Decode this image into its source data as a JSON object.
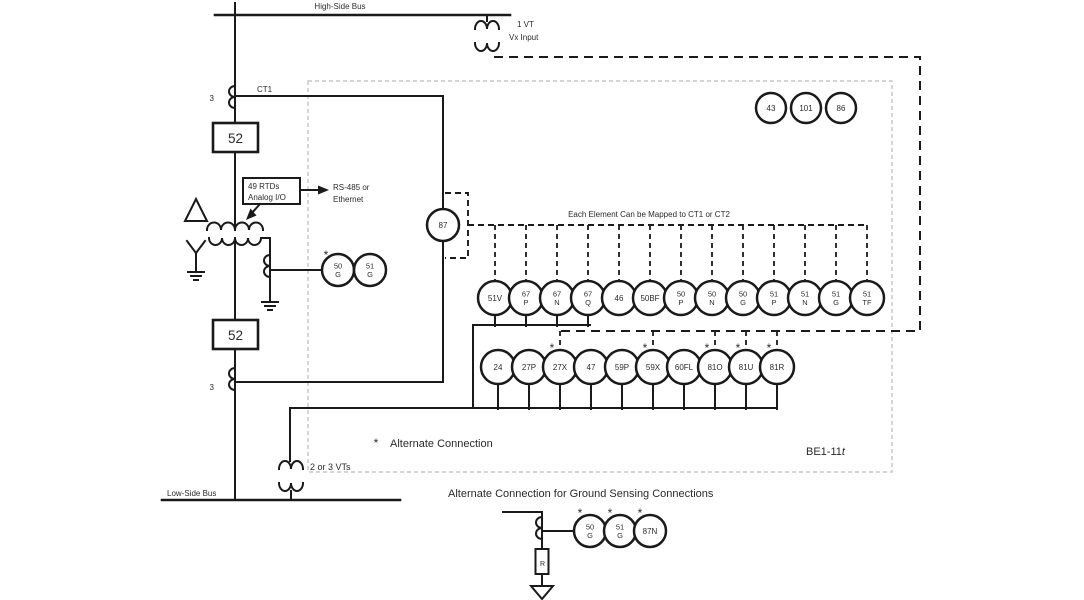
{
  "labels": {
    "high_side_bus": "High-Side Bus",
    "low_side_bus": "Low-Side Bus",
    "vt_top_line1": "1 VT",
    "vt_top_line2": "Vx Input",
    "ct1": "CT1",
    "ct1_phases": "3",
    "ct2_phases": "3",
    "breaker_top": "52",
    "breaker_bottom": "52",
    "rtd_box_line1": "49 RTDs",
    "rtd_box_line2": "Analog I/O",
    "comm_line1": "RS-485 or",
    "comm_line2": "Ethernet",
    "mapping_note": "Each Element Can be Mapped to CT1 or CT2",
    "star": "*",
    "alternate_note": "Alternate Connection",
    "device_name": "BE1-11",
    "device_suffix": "t",
    "vts_bottom": "2 or 3 VTs",
    "ground_sensing_title": "Alternate Connection for Ground Sensing Connections",
    "resistor": "R"
  },
  "elements": {
    "differential": "87",
    "control": [
      {
        "lines": [
          "43"
        ]
      },
      {
        "lines": [
          "101"
        ]
      },
      {
        "lines": [
          "86"
        ]
      }
    ],
    "transformer_ground": [
      {
        "lines": [
          "50",
          "G"
        ],
        "star": true
      },
      {
        "lines": [
          "51",
          "G"
        ]
      }
    ],
    "row1": [
      {
        "lines": [
          "51V"
        ],
        "wired": true
      },
      {
        "lines": [
          "67",
          "P"
        ],
        "wired": true
      },
      {
        "lines": [
          "67",
          "N"
        ],
        "wired": true
      },
      {
        "lines": [
          "67",
          "Q"
        ],
        "wired": true
      },
      {
        "lines": [
          "46"
        ]
      },
      {
        "lines": [
          "50BF"
        ]
      },
      {
        "lines": [
          "50",
          "P"
        ]
      },
      {
        "lines": [
          "50",
          "N"
        ]
      },
      {
        "lines": [
          "50",
          "G"
        ]
      },
      {
        "lines": [
          "51",
          "P"
        ]
      },
      {
        "lines": [
          "51",
          "N"
        ]
      },
      {
        "lines": [
          "51",
          "G"
        ]
      },
      {
        "lines": [
          "51",
          "TF"
        ]
      }
    ],
    "row2": [
      {
        "lines": [
          "24"
        ]
      },
      {
        "lines": [
          "27P"
        ]
      },
      {
        "lines": [
          "27X"
        ],
        "star": true,
        "vx": true
      },
      {
        "lines": [
          "47"
        ]
      },
      {
        "lines": [
          "59P"
        ]
      },
      {
        "lines": [
          "59X"
        ],
        "star": true,
        "vx": true
      },
      {
        "lines": [
          "60FL"
        ]
      },
      {
        "lines": [
          "81O"
        ],
        "star": true,
        "vx": true
      },
      {
        "lines": [
          "81U"
        ],
        "star": true,
        "vx": true
      },
      {
        "lines": [
          "81R"
        ],
        "star": true,
        "vx": true
      }
    ],
    "ground_sensing": [
      {
        "lines": [
          "50",
          "G"
        ],
        "star": true
      },
      {
        "lines": [
          "51",
          "G"
        ],
        "star": true
      },
      {
        "lines": [
          "87N"
        ],
        "star": true
      }
    ]
  }
}
